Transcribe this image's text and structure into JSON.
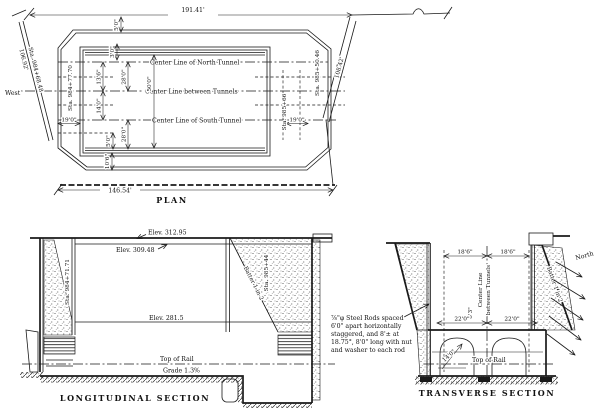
{
  "colors": {
    "ink": "#1a1a1a",
    "paper": "#ffffff"
  },
  "plan": {
    "label": "PLAN",
    "dim_width_top": "191.41'",
    "dim_width_bottom": "146.54'",
    "west": "West",
    "left_diag_length": "106.92'",
    "left_diag_sta": "Sta. 984+68.48",
    "right_diag_length": "108.42'",
    "right_diag_sta": "Sta. 985+50.46",
    "sta_inner_left": "Sta. 984+77.70",
    "sta_inner_right": "Sta. 985+66",
    "cl_north_tunnel": "Center Line of North Tunnel",
    "cl_between_tunnels": "Center Line between Tunnels",
    "cl_south_tunnel": "Center Line of South Tunnel",
    "dim_5_0_top": "5'0\"",
    "dim_3_0": "3'0\"",
    "dim_13_6": "13'6\"",
    "dim_14_0": "14'0\"",
    "dim_28_0_upper": "28'0\"",
    "dim_28_0_lower": "28'0\"",
    "dim_50_0": "50'0\"",
    "dim_5_0_bottom": "5'0\"",
    "dim_10_6": "10'6\"",
    "dim_19_0_left": "19'0\"",
    "dim_19_0_right": "19'0\""
  },
  "longitudinal": {
    "label": "LONGITUDINAL SECTION",
    "elev_top": "Elev. 312.95",
    "elev_mid": "Elev. 309.48",
    "elev_floor": "Elev. 281.5",
    "sta_left": "Sta. 984+71.71",
    "sta_right": "Sta. 985+44",
    "batter": "Batter 1 in 2",
    "top_of_rail": "Top of Rail",
    "grade": "Grade 1.3%"
  },
  "transverse": {
    "label": "TRANSVERSE SECTION",
    "dim_left_half": "18'6\"",
    "dim_right_half": "18'6\"",
    "cl_line1": "Center Line",
    "cl_line2": "between Tunnels",
    "batter": "Batter 1 in 2",
    "north": "North",
    "dim_center": "6'3\"",
    "dim_arch_left": "22'0\"",
    "dim_arch_right": "22'0\"",
    "dim_radius": "14'0\"",
    "top_of_rail": "Top of Rail"
  },
  "rod_note": {
    "line1": "⅞\"φ Steel Rods spaced",
    "line2": "6'0\" apart horizontally",
    "line3": "staggered, and 8'± at",
    "line4": "18.75°, 8'0\" long with nut",
    "line5": "and washer to each rod"
  }
}
